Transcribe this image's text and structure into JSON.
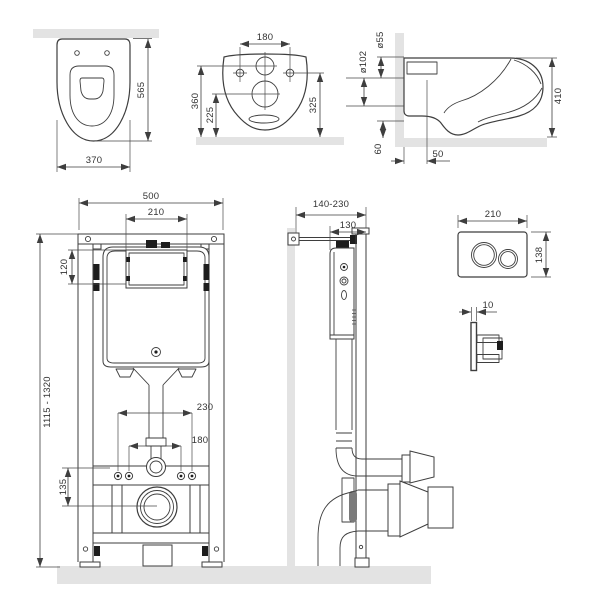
{
  "colors": {
    "line": "#3e3e3e",
    "text": "#333333",
    "wall_floor_surface": "#e3e3e3",
    "clip_black": "#1d1d1d"
  },
  "views": {
    "toilet_top": {
      "height": "565",
      "width": "370"
    },
    "toilet_rear": {
      "hole_spacing": "180",
      "flush_height": "360",
      "drain_height": "225",
      "fixing_height": "325"
    },
    "toilet_side": {
      "flush_diameter": "ø55",
      "drain_diameter": "ø102",
      "height": "410",
      "drain_axis_height": "60",
      "drain_axis_offset": "50"
    },
    "frame_front": {
      "width": "500",
      "service_opening": "210",
      "cistern_offset": "120",
      "height_range": "1115 - 1320",
      "fixing_outer": "230",
      "fixing_inner": "180",
      "drain_axis_height": "135"
    },
    "frame_side": {
      "mounting_depth": "140-230",
      "frame_depth": "130"
    },
    "flush_plate": {
      "width": "210",
      "height": "138",
      "thickness": "10"
    }
  }
}
